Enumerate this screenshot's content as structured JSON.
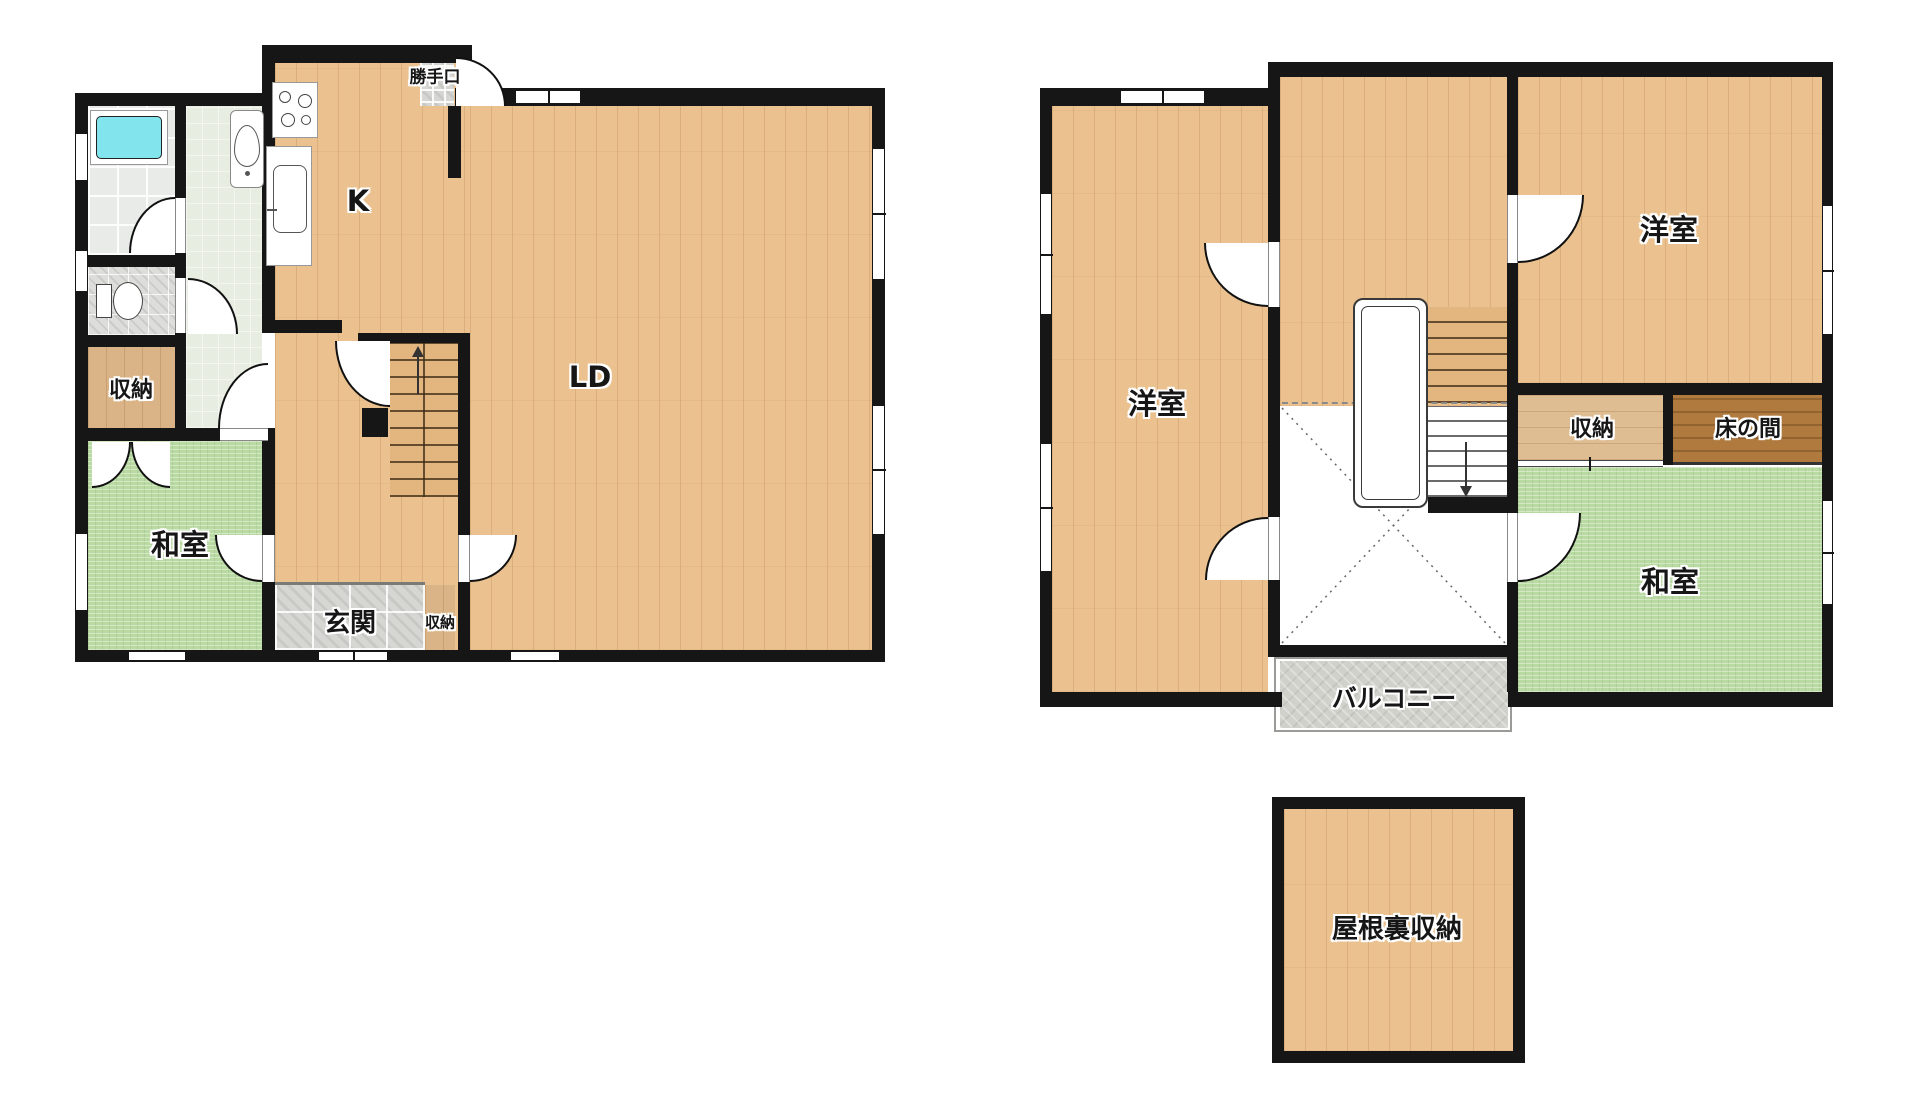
{
  "floor1": {
    "back_door_label": "勝手口",
    "kitchen_label": "K",
    "living_dining_label": "LD",
    "storage_label": "収納",
    "japanese_room_label": "和室",
    "entrance_label": "玄関",
    "entrance_storage_label": "収納"
  },
  "floor2": {
    "western_room_left_label": "洋室",
    "western_room_right_label": "洋室",
    "storage_label": "収納",
    "tokonoma_label": "床の間",
    "japanese_room_label": "和室",
    "balcony_label": "バルコニー"
  },
  "attic": {
    "label": "屋根裏収納"
  },
  "colors": {
    "wall": "#161616",
    "wood_floor": "#ebc28f",
    "tatami": "#b9daa2",
    "bathtub": "#82e4ec",
    "entrance_tile": "#d6d6d2",
    "tokonoma_wood": "#b07a3e",
    "balcony_concrete": "#d1d1cb"
  }
}
